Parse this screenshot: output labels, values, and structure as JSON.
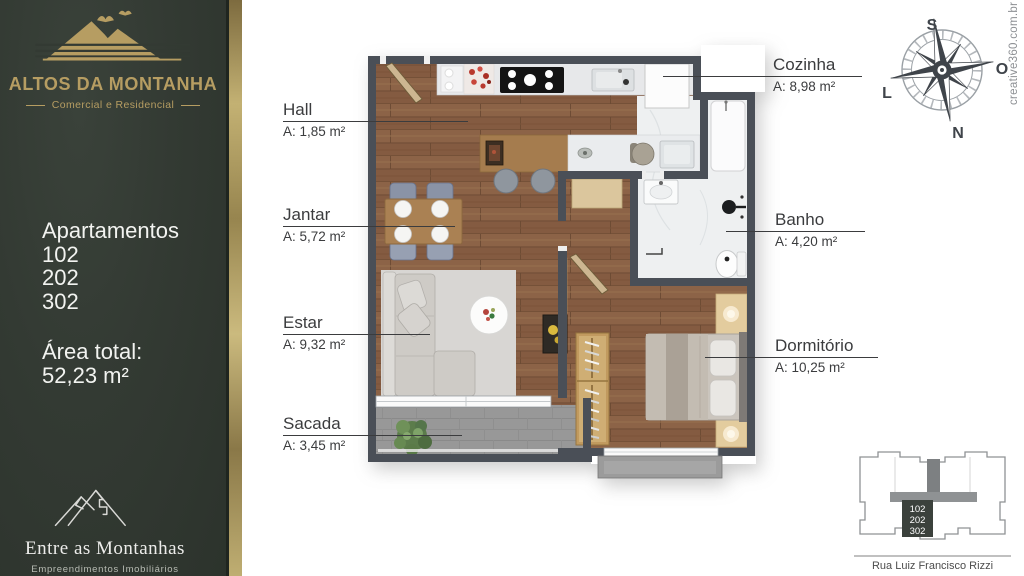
{
  "sidebar": {
    "brand": {
      "name": "ALTOS DA MONTANHA",
      "tagline": "Comercial e Residencial"
    },
    "apartments": {
      "heading": "Apartamentos",
      "units": [
        "102",
        "202",
        "302"
      ]
    },
    "total_area": {
      "label": "Área total:",
      "value": "52,23 m²"
    },
    "footer_brand": {
      "name": "Entre as Montanhas",
      "tagline": "Empreendimentos Imobiliários"
    }
  },
  "floorplan": {
    "rooms": [
      {
        "name": "Hall",
        "area": "A: 1,85 m²"
      },
      {
        "name": "Jantar",
        "area": "A: 5,72 m²"
      },
      {
        "name": "Estar",
        "area": "A: 9,32 m²"
      },
      {
        "name": "Sacada",
        "area": "A: 3,45 m²"
      },
      {
        "name": "Cozinha",
        "area": "A: 8,98 m²"
      },
      {
        "name": "Banho",
        "area": "A: 4,20 m²"
      },
      {
        "name": "Dormitório",
        "area": "A: 10,25 m²"
      }
    ]
  },
  "compass": {
    "top": "S",
    "right": "O",
    "left": "L",
    "bottom": "N"
  },
  "watermark": "creative360.com.br",
  "key_plan": {
    "units": [
      "102",
      "202",
      "302"
    ],
    "street": "Rua Luiz Francisco Rizzi"
  },
  "colors": {
    "sidebar_green": "#333a33",
    "gold": "#b69d62",
    "wall": "#4a4f57"
  }
}
